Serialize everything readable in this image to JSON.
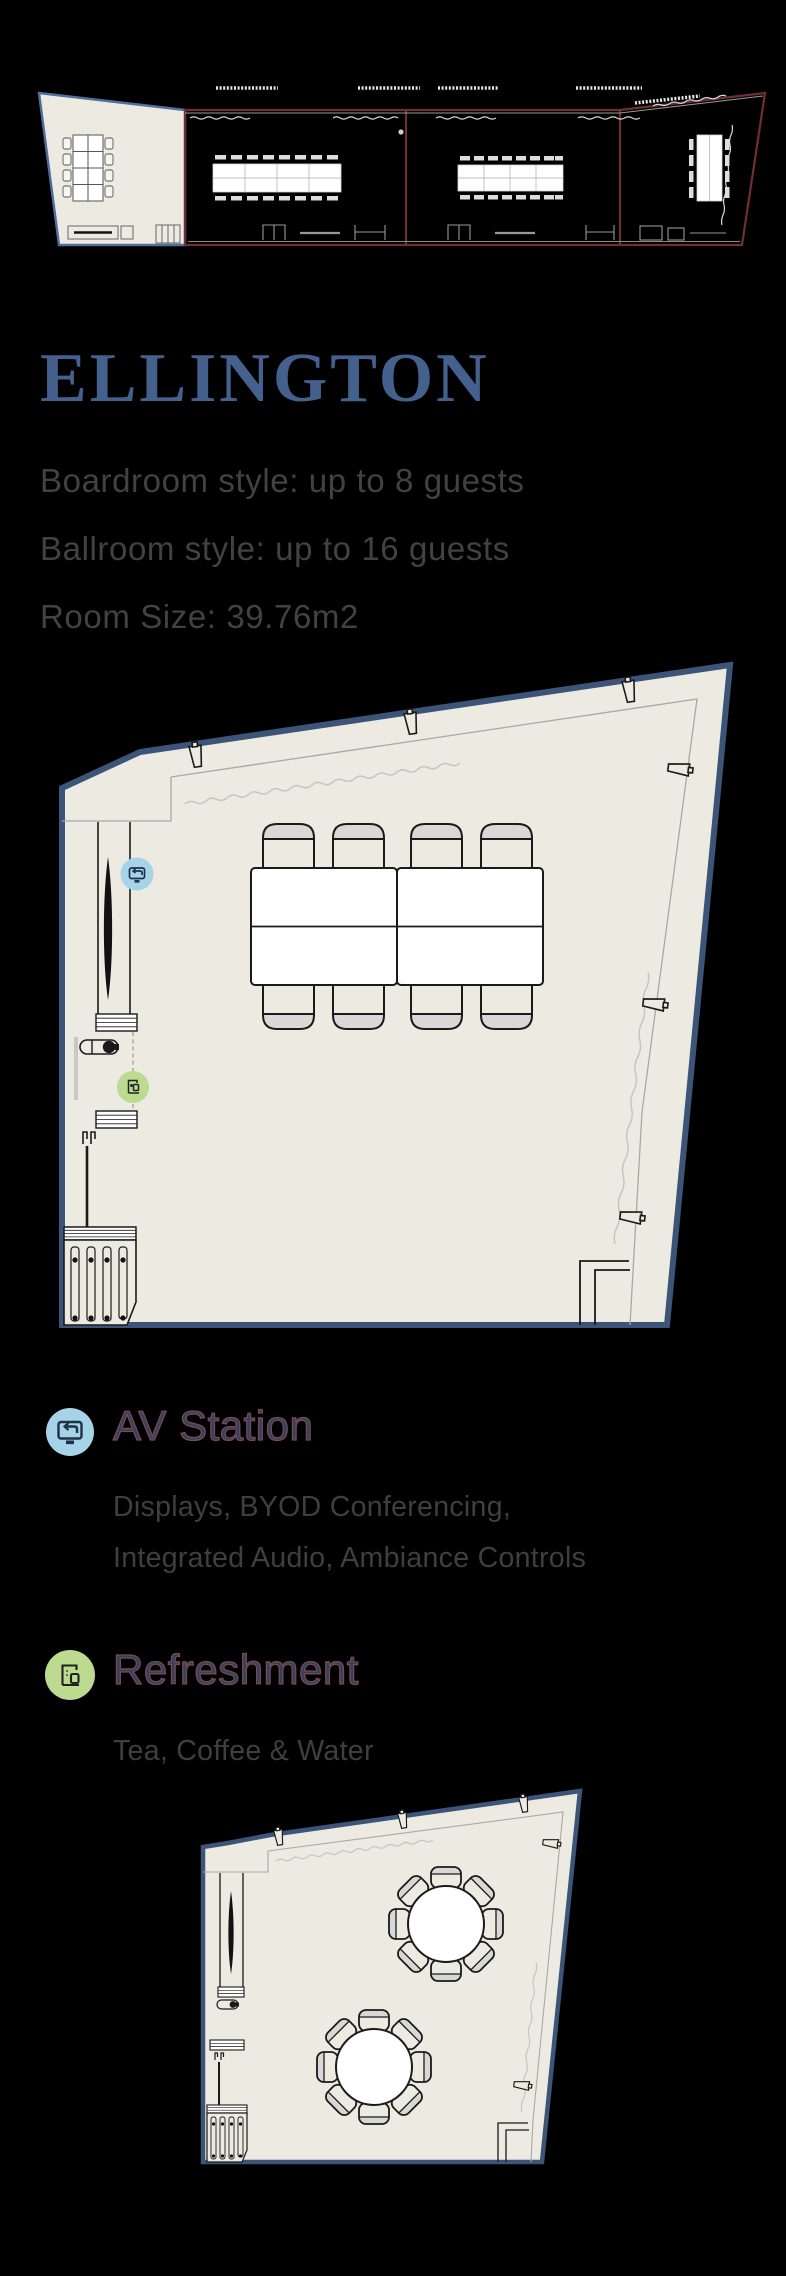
{
  "window": {
    "width": 786,
    "height": 2276,
    "background": "#000000"
  },
  "overview": {
    "description": "building-floor-overview",
    "highlighted_room": "ELLINGTON",
    "room_count": 4,
    "highlight_fill": "#ECEAE1",
    "highlight_stroke": "#4F6E9E",
    "other_rooms_stroke": "#6F2F33"
  },
  "header": {
    "title": "ELLINGTON",
    "title_color": "#44608D"
  },
  "specs": {
    "lines": [
      "Boardroom style: up to 8 guests",
      "Ballroom style: up to 16 guests",
      "Room Size: 39.76m2"
    ],
    "text_color": "#424242"
  },
  "main_plan": {
    "description": "boardroom-layout-floor-plan",
    "seats": 8,
    "room_fill": "#ECEAE1",
    "outline_color": "#3C5477",
    "markers": [
      {
        "id": "av-station",
        "icon": "display-cast-icon",
        "color": "#A7D3E8"
      },
      {
        "id": "refreshment",
        "icon": "coffee-machine-icon",
        "color": "#BCDA90"
      }
    ]
  },
  "legend": {
    "items": [
      {
        "title": "AV Station",
        "icon": "display-cast-icon",
        "icon_bg": "#A7D3E8",
        "description_lines": [
          "Displays, BYOD Conferencing,",
          "Integrated Audio, Ambiance Controls"
        ]
      },
      {
        "title": "Refreshment",
        "icon": "coffee-machine-icon",
        "icon_bg": "#BCDA90",
        "description_lines": [
          "Tea, Coffee & Water"
        ]
      }
    ],
    "title_color": "#2E4361",
    "title_outline": "#7D4752",
    "description_color": "#3F3F3F"
  },
  "ballroom_plan": {
    "description": "ballroom-layout-floor-plan",
    "tables": 2,
    "seats_per_table": 8,
    "room_fill": "#ECEAE1",
    "outline_color": "#3C5477"
  }
}
